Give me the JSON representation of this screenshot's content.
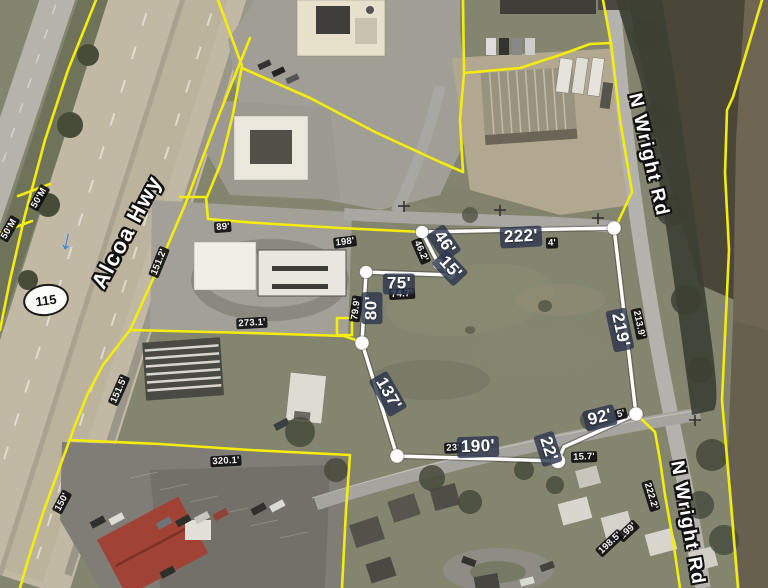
{
  "roads": {
    "alcoa_hwy": "Alcoa Hwy",
    "n_wright_rd_upper": "N Wright Rd",
    "n_wright_rd_lower": "N Wright Rd",
    "route_shield": "115"
  },
  "icons": {
    "traffic_arrow": "↓"
  },
  "colors": {
    "parcel_boundary_yellow": "#f4ec0c",
    "selected_parcel_white": "#ffffff",
    "primary_label_bg": "#2d374e",
    "secondary_label_bg": "#0a0a0c"
  },
  "measurements": {
    "primary": [
      {
        "text": "46'",
        "x": 444,
        "y": 243,
        "rot": 55
      },
      {
        "text": "222'",
        "x": 521,
        "y": 237,
        "rot": -3
      },
      {
        "text": "75'",
        "x": 399,
        "y": 284,
        "rot": 0
      },
      {
        "text": "15'",
        "x": 450,
        "y": 268,
        "rot": 47
      },
      {
        "text": "80'",
        "x": 372,
        "y": 308,
        "rot": -90
      },
      {
        "text": "137'",
        "x": 388,
        "y": 394,
        "rot": 60
      },
      {
        "text": "190'",
        "x": 478,
        "y": 447,
        "rot": -2
      },
      {
        "text": "22'",
        "x": 548,
        "y": 449,
        "rot": 72
      },
      {
        "text": "92'",
        "x": 600,
        "y": 418,
        "rot": -14
      },
      {
        "text": "219'",
        "x": 620,
        "y": 330,
        "rot": 78
      }
    ],
    "secondary": [
      {
        "text": "50'M",
        "x": 39,
        "y": 198,
        "rot": -60
      },
      {
        "text": "50'M",
        "x": 9,
        "y": 229,
        "rot": -60
      },
      {
        "text": "89'",
        "x": 223,
        "y": 227,
        "rot": -4
      },
      {
        "text": "198'",
        "x": 345,
        "y": 242,
        "rot": -7
      },
      {
        "text": "151.2'",
        "x": 159,
        "y": 262,
        "rot": -68
      },
      {
        "text": "46.2'",
        "x": 421,
        "y": 251,
        "rot": 66
      },
      {
        "text": "74.7'",
        "x": 402,
        "y": 294,
        "rot": -3
      },
      {
        "text": "79.9'",
        "x": 356,
        "y": 309,
        "rot": -82
      },
      {
        "text": "273.1'",
        "x": 252,
        "y": 323,
        "rot": -3
      },
      {
        "text": "213.9'",
        "x": 639,
        "y": 324,
        "rot": 78
      },
      {
        "text": "151.5'",
        "x": 119,
        "y": 390,
        "rot": -66
      },
      {
        "text": "320.1'",
        "x": 226,
        "y": 461,
        "rot": -3
      },
      {
        "text": "150'",
        "x": 62,
        "y": 502,
        "rot": -62
      },
      {
        "text": "23'",
        "x": 453,
        "y": 448,
        "rot": -2
      },
      {
        "text": "4'",
        "x": 552,
        "y": 243,
        "rot": -2
      },
      {
        "text": "5'",
        "x": 621,
        "y": 414,
        "rot": -14
      },
      {
        "text": "15.7'",
        "x": 584,
        "y": 457,
        "rot": -2
      },
      {
        "text": "222.2'",
        "x": 651,
        "y": 496,
        "rot": 73
      },
      {
        "text": "199'",
        "x": 628,
        "y": 531,
        "rot": -43
      },
      {
        "text": "198.5'",
        "x": 610,
        "y": 543,
        "rot": -43
      }
    ]
  }
}
